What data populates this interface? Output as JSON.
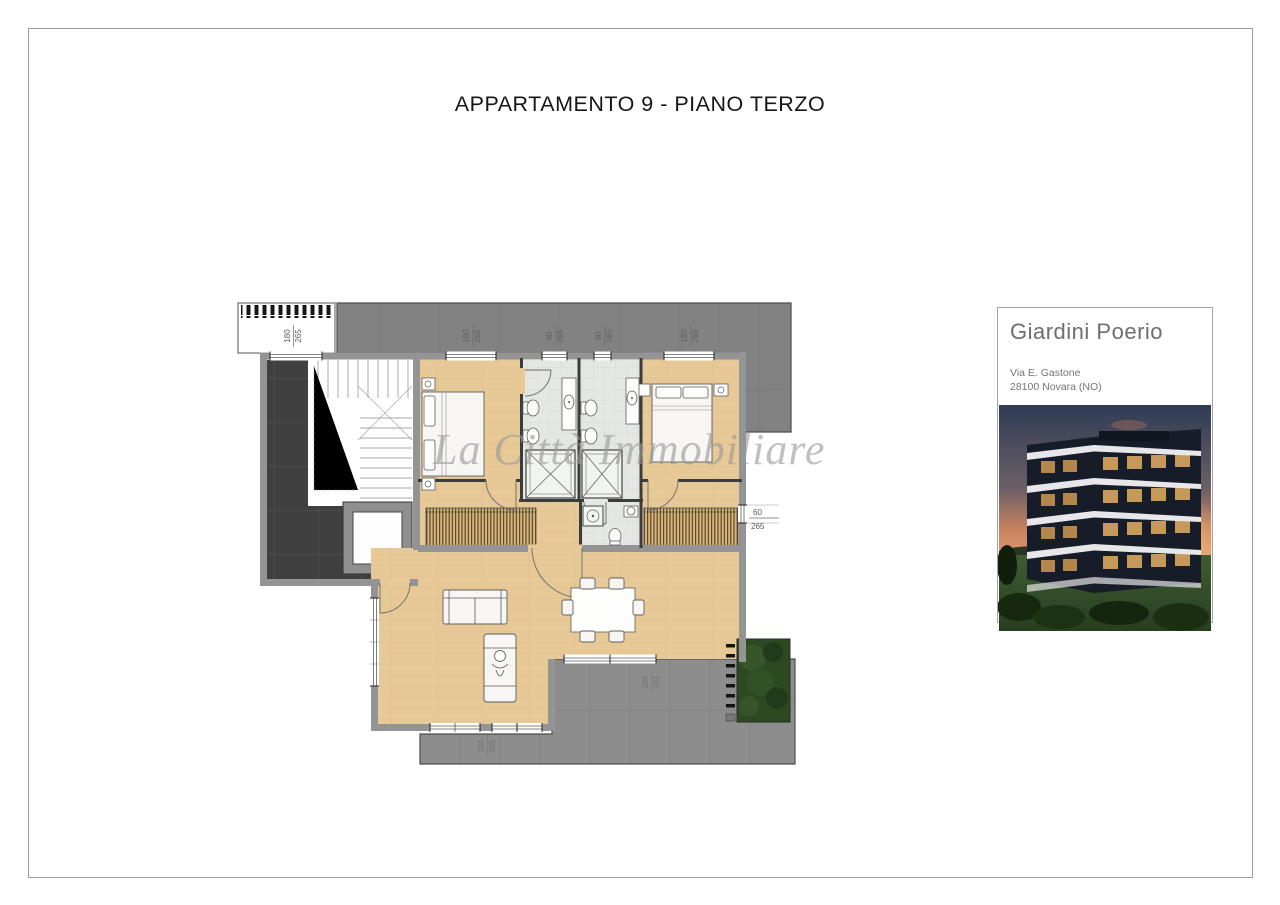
{
  "page": {
    "title": "APPARTAMENTO 9 - PIANO TERZO"
  },
  "watermark": {
    "text": "La Città Immobiliare"
  },
  "project_card": {
    "title": "Giardini Poerio",
    "address_line1": "Via E. Gastone",
    "address_line2": "28100 Novara (NO)"
  },
  "plan": {
    "dimensions": {
      "balcony_door": {
        "w": "180",
        "h": "265"
      },
      "bedroom1_window": {
        "w": "180",
        "h": "265"
      },
      "bath1_window": {
        "w": "90",
        "h": "265"
      },
      "bath2_window": {
        "w": "60",
        "h": "265"
      },
      "bedroom2_window": {
        "w": "180",
        "h": "265"
      },
      "right_window": {
        "w": "60",
        "h": "265"
      },
      "terrace_door": {
        "w": "300",
        "h": "265"
      },
      "living_door": {
        "w": "240",
        "h": "265"
      }
    }
  },
  "colors": {
    "wood": "#e7c897",
    "bath_tile": "#e4e7e3",
    "landing_dark": "#404040",
    "terrace": "#828282",
    "terrace_lower": "#8d8d8d",
    "planter_green": "#2c4a22",
    "wall": "#949494",
    "partition": "#3c3c3c",
    "watermark_gray": "#9a9a9a",
    "card_text": "#6e6e6e"
  }
}
